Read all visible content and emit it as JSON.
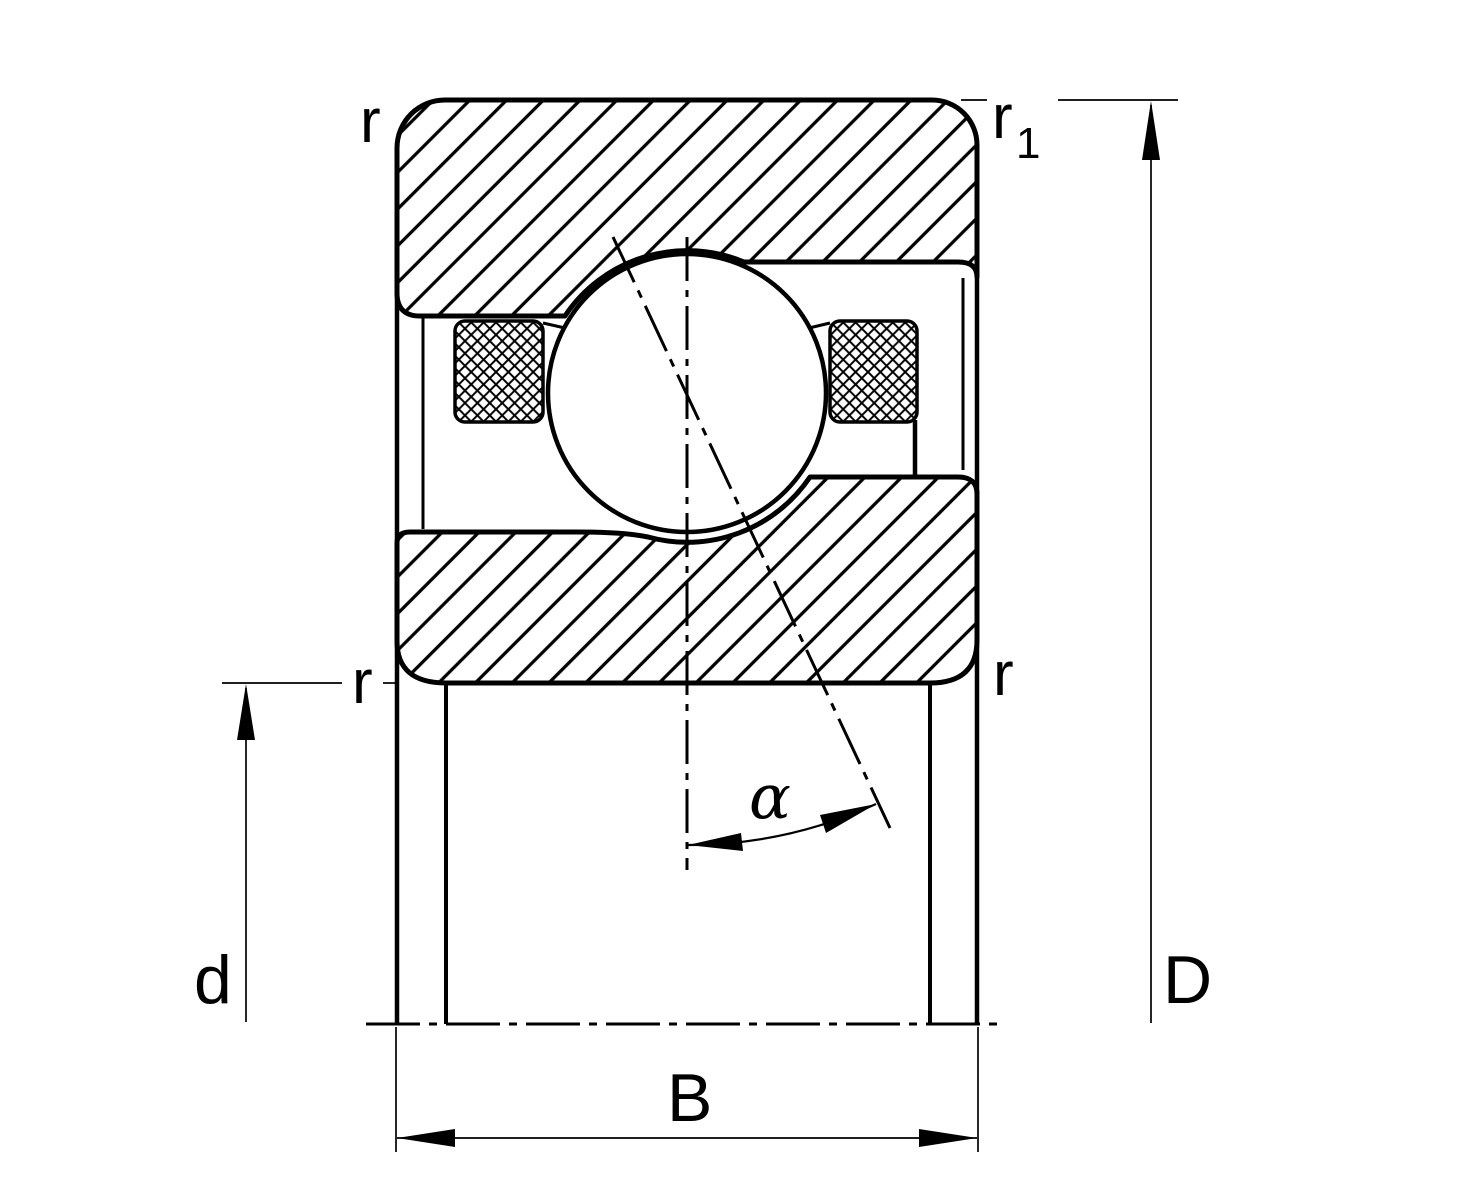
{
  "diagram": {
    "title": "angular-contact-ball-bearing-cross-section",
    "colors": {
      "line": "#000000",
      "background": "#ffffff"
    },
    "labels": {
      "corner_radius_top_left": "r",
      "corner_radius_outer_base": "r",
      "corner_radius_outer_sub": "1",
      "corner_radius_mid_left": "r",
      "corner_radius_mid_right": "r",
      "bore_diameter": "d",
      "outside_diameter": "D",
      "width": "B",
      "contact_angle": "α"
    }
  }
}
